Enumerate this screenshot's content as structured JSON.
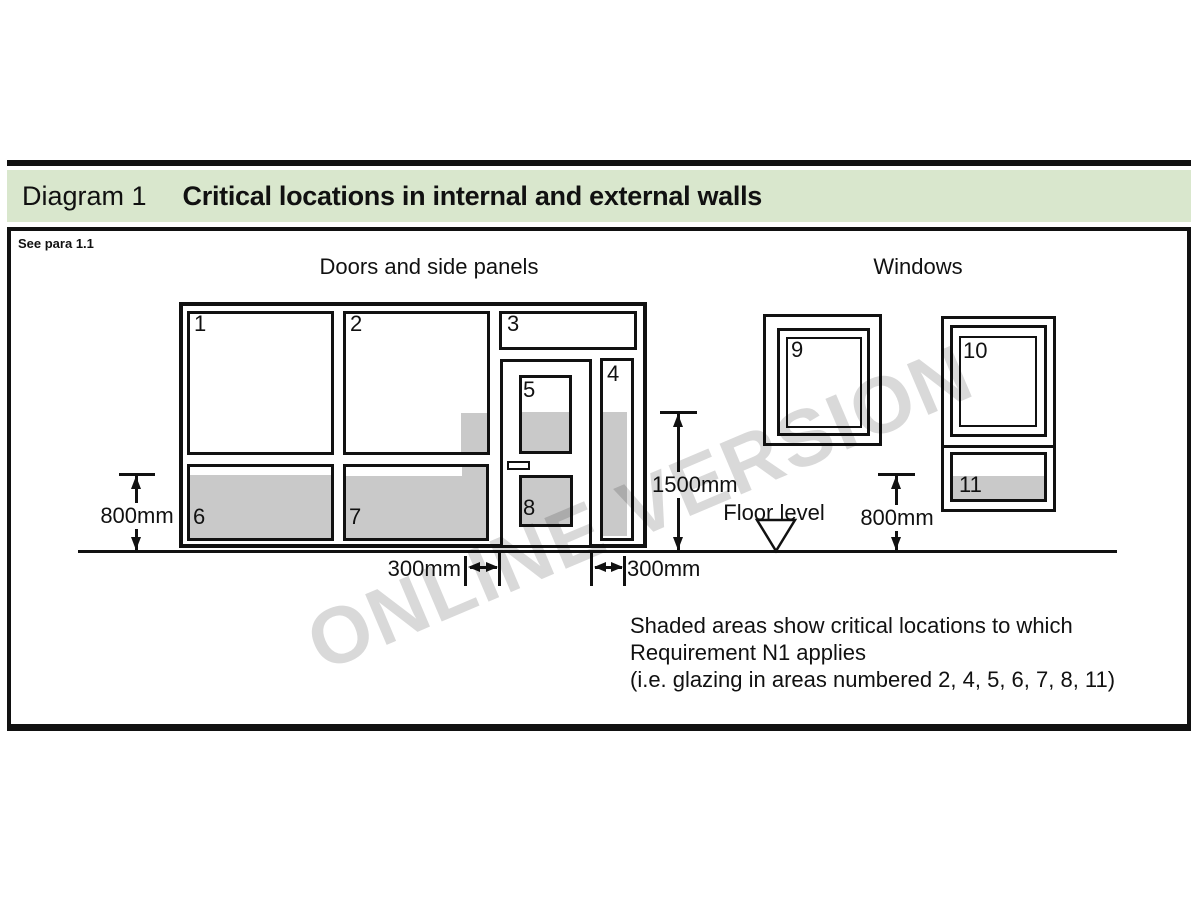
{
  "page": {
    "header": {
      "doc_label": "Diagram 1",
      "title": "Critical locations in internal and external walls"
    },
    "see_para": "See para 1.1",
    "sections": {
      "doors": "Doors and side panels",
      "windows": "Windows"
    },
    "panel_numbers": {
      "p1": "1",
      "p2": "2",
      "p3": "3",
      "p4": "4",
      "p5": "5",
      "p6": "6",
      "p7": "7",
      "p8": "8",
      "p9": "9",
      "p10": "10",
      "p11": "11"
    },
    "dimensions": {
      "left_height": "800mm",
      "door_height": "1500mm",
      "left_offset": "300mm",
      "right_offset": "300mm",
      "right_height": "800mm"
    },
    "floor_label": "Floor level",
    "caption": {
      "line1": "Shaded areas show critical locations to which",
      "line2": "Requirement N1 applies",
      "line3": "(i.e. glazing in areas numbered 2, 4, 5, 6, 7, 8, 11)"
    },
    "watermark": "ONLINE VERSION",
    "colors": {
      "header_green": "#d9e7cd",
      "shade_gray": "#c9c9c9",
      "line_black": "#111111",
      "watermark_gray": "#d9d9d9"
    }
  }
}
